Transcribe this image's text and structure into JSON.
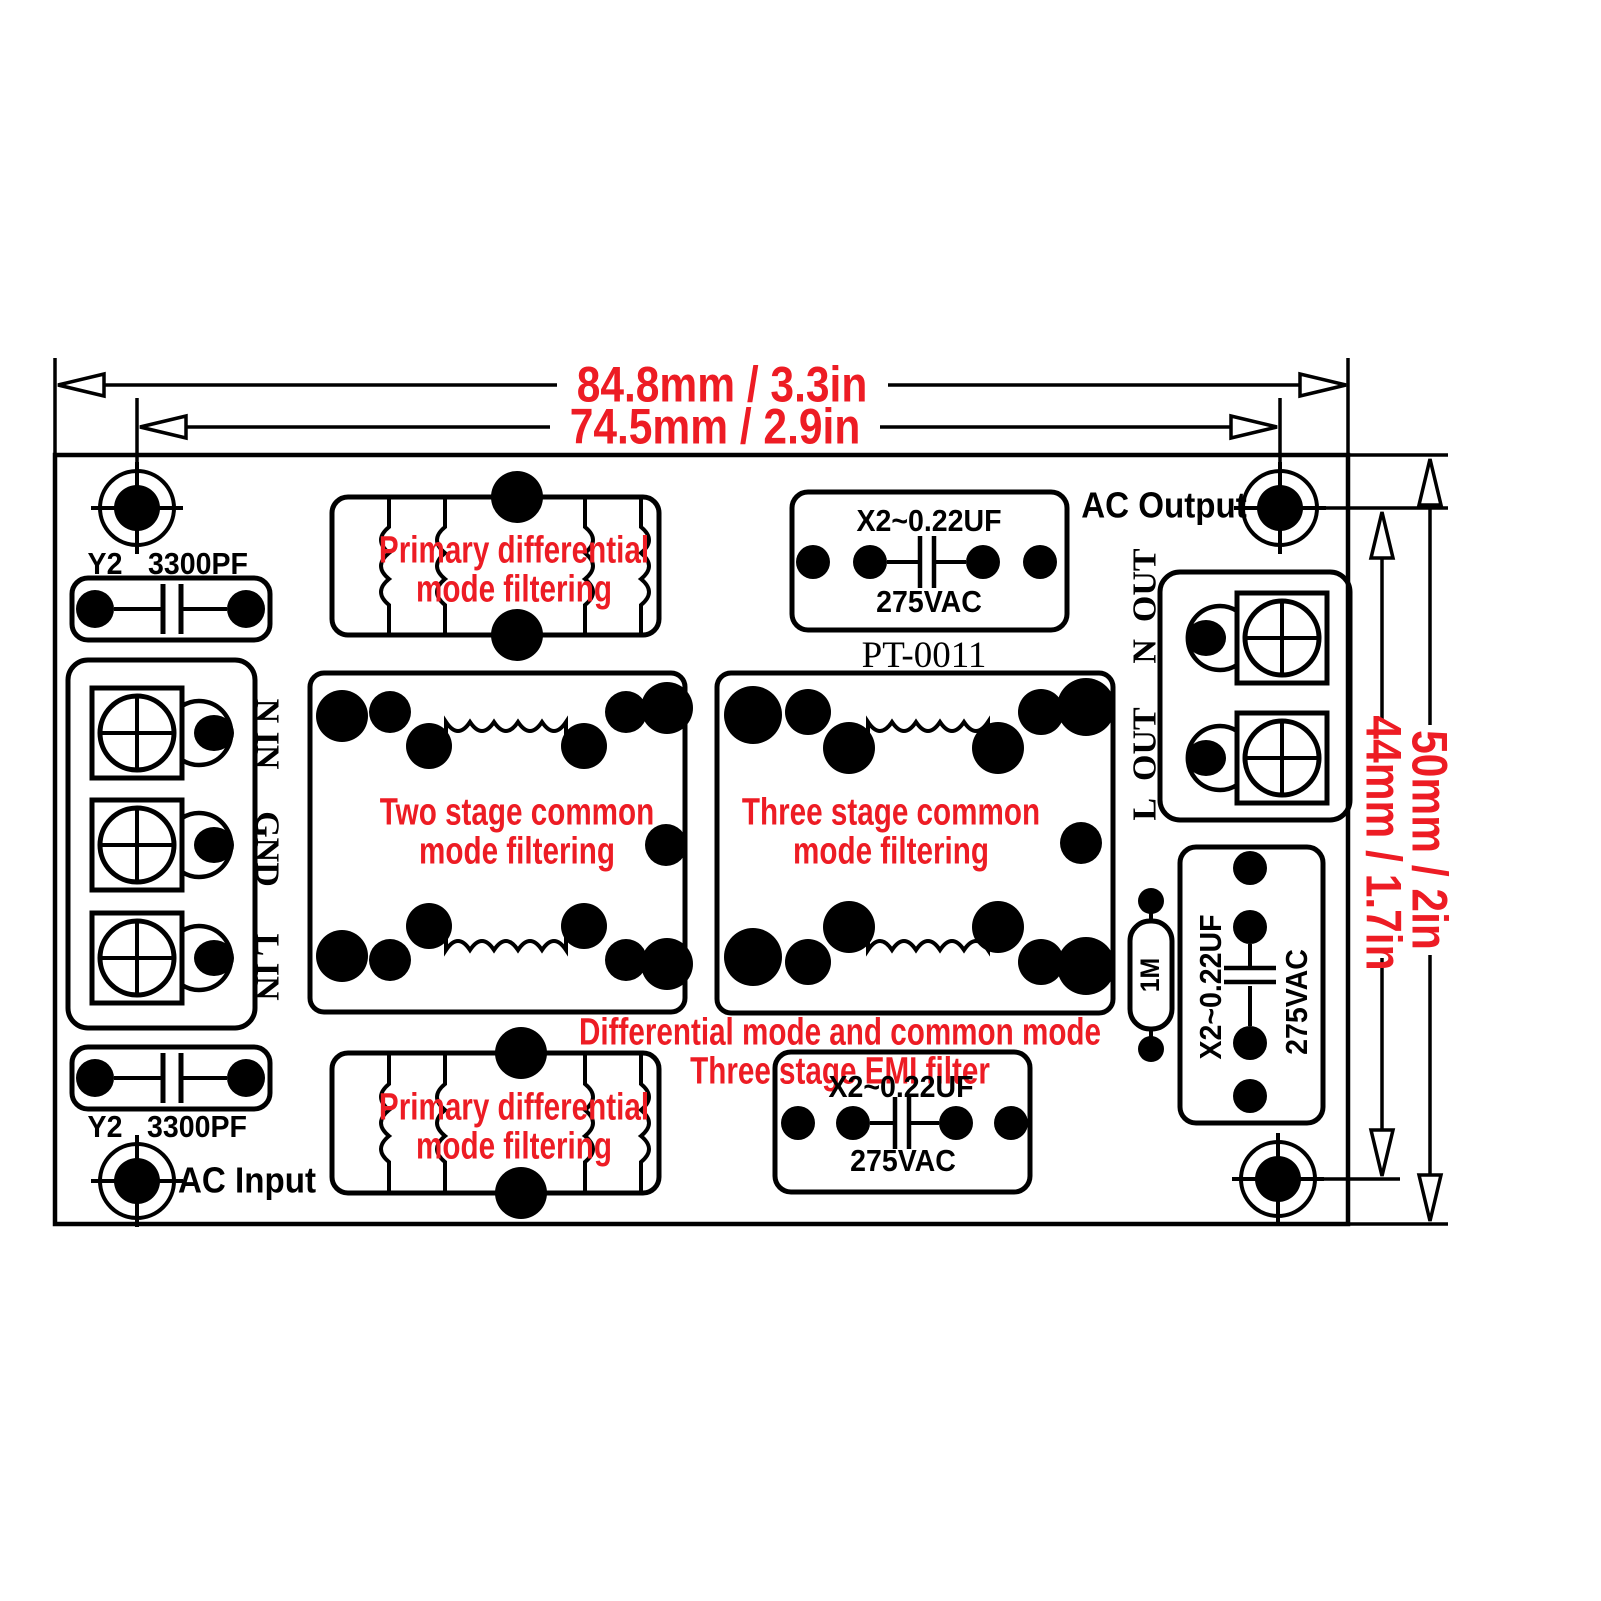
{
  "dimensions": {
    "width_outer": "84.8mm / 3.3in",
    "width_inner": "74.5mm / 2.9in",
    "height_outer": "50mm / 2in",
    "height_inner": "44mm / 1.7in"
  },
  "ports": {
    "ac_input": "AC Input",
    "ac_output": "AC Output",
    "n_in": "N IN",
    "gnd": "GND",
    "l_in": "L IN",
    "n_out": "N_OUT",
    "l_out": "L_OUT"
  },
  "components": {
    "y2_cap_top": {
      "series": "Y2",
      "value": "3300PF"
    },
    "y2_cap_bottom": {
      "series": "Y2",
      "value": "3300PF"
    },
    "x2_cap_top": {
      "value": "X2~0.22UF",
      "rating": "275VAC"
    },
    "x2_cap_bottom": {
      "value": "X2~0.22UF",
      "rating": "275VAC"
    },
    "x2_cap_right": {
      "value": "X2~0.22UF",
      "rating": "275VAC"
    },
    "bleeder_resistor": {
      "value": "1M"
    },
    "board_model": "PT-0011"
  },
  "annotations": {
    "primary_diff_top": "Primary differential\nmode filtering",
    "primary_diff_bottom": "Primary differential\nmode filtering",
    "two_stage": "Two stage common\nmode filtering",
    "three_stage": "Three stage common\nmode filtering",
    "summary": "Differential mode and common mode\nThree stage EMI filter"
  },
  "colors": {
    "annotation_red": "#ed1c24",
    "line_black": "#000000"
  }
}
